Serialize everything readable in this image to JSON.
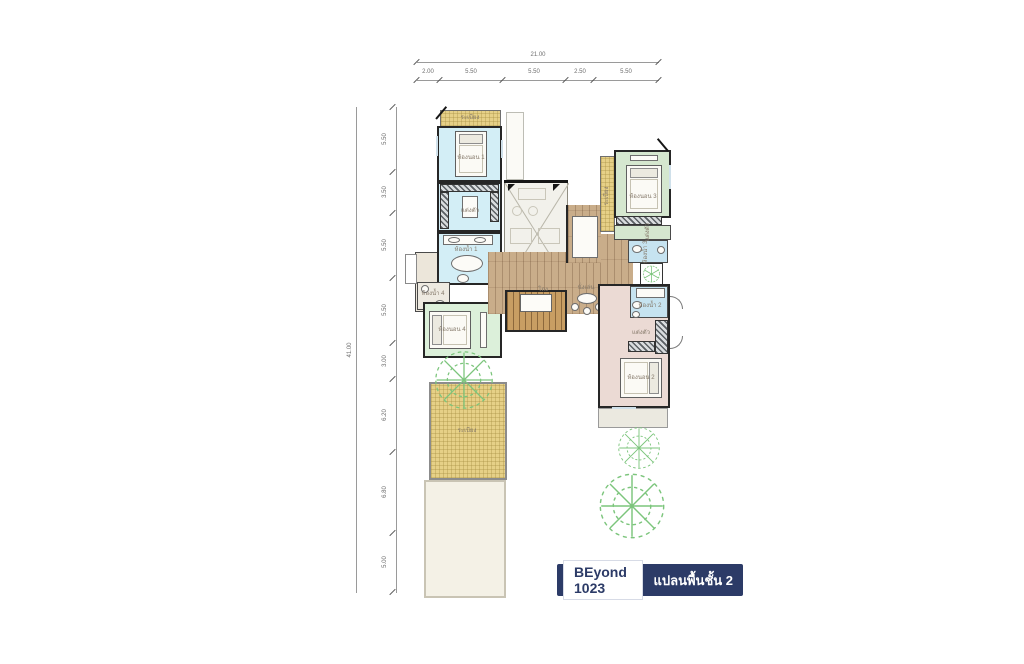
{
  "badge": {
    "model": "BEyond 1023",
    "plan_label": "แปลนพื้นชั้น 2"
  },
  "dimensions": {
    "top": {
      "total": "21.00",
      "segments": [
        "2.00",
        "5.50",
        "5.50",
        "2.50",
        "5.50"
      ]
    },
    "left": {
      "total": "41.00",
      "segments": [
        "5.50",
        "3.50",
        "5.50",
        "5.50",
        "3.00",
        "6.20",
        "6.80",
        "5.00"
      ]
    }
  },
  "rooms": {
    "balcony_top": "ระเบียง",
    "bedroom1": "ห้องนอน 1",
    "dressing1": "แต่งตัว",
    "bath1": "ห้องน้ำ 1",
    "bath4": "ห้องน้ำ 4",
    "bedroom4": "ห้องนอน 4",
    "hall": "โถง",
    "sitting": "นั่งเล่น",
    "balcony3": "ระเบียง",
    "bedroom3": "ห้องนอน 3",
    "dressing3": "แต่งตัว",
    "bath3": "ห้องน้ำ 3",
    "bath2": "ห้องน้ำ 2",
    "dressing2": "แต่งตัว",
    "bedroom2": "ห้องนอน 2",
    "terrace": "ระเบียง"
  },
  "colors": {
    "accent_navy": "#2c3b67",
    "bedroom1_fill": "#d3eef6",
    "bedroom3_fill": "#d5e7cf",
    "bedroom4_fill": "#dcf0da",
    "bedroom2_fill": "#ebdad4",
    "bathroom_fill": "#c6e3f0",
    "balcony_fill": "#e6d087",
    "wood_fill": "#c9ad8a",
    "tree_stroke": "#7cc57c",
    "wall": "#262626"
  }
}
